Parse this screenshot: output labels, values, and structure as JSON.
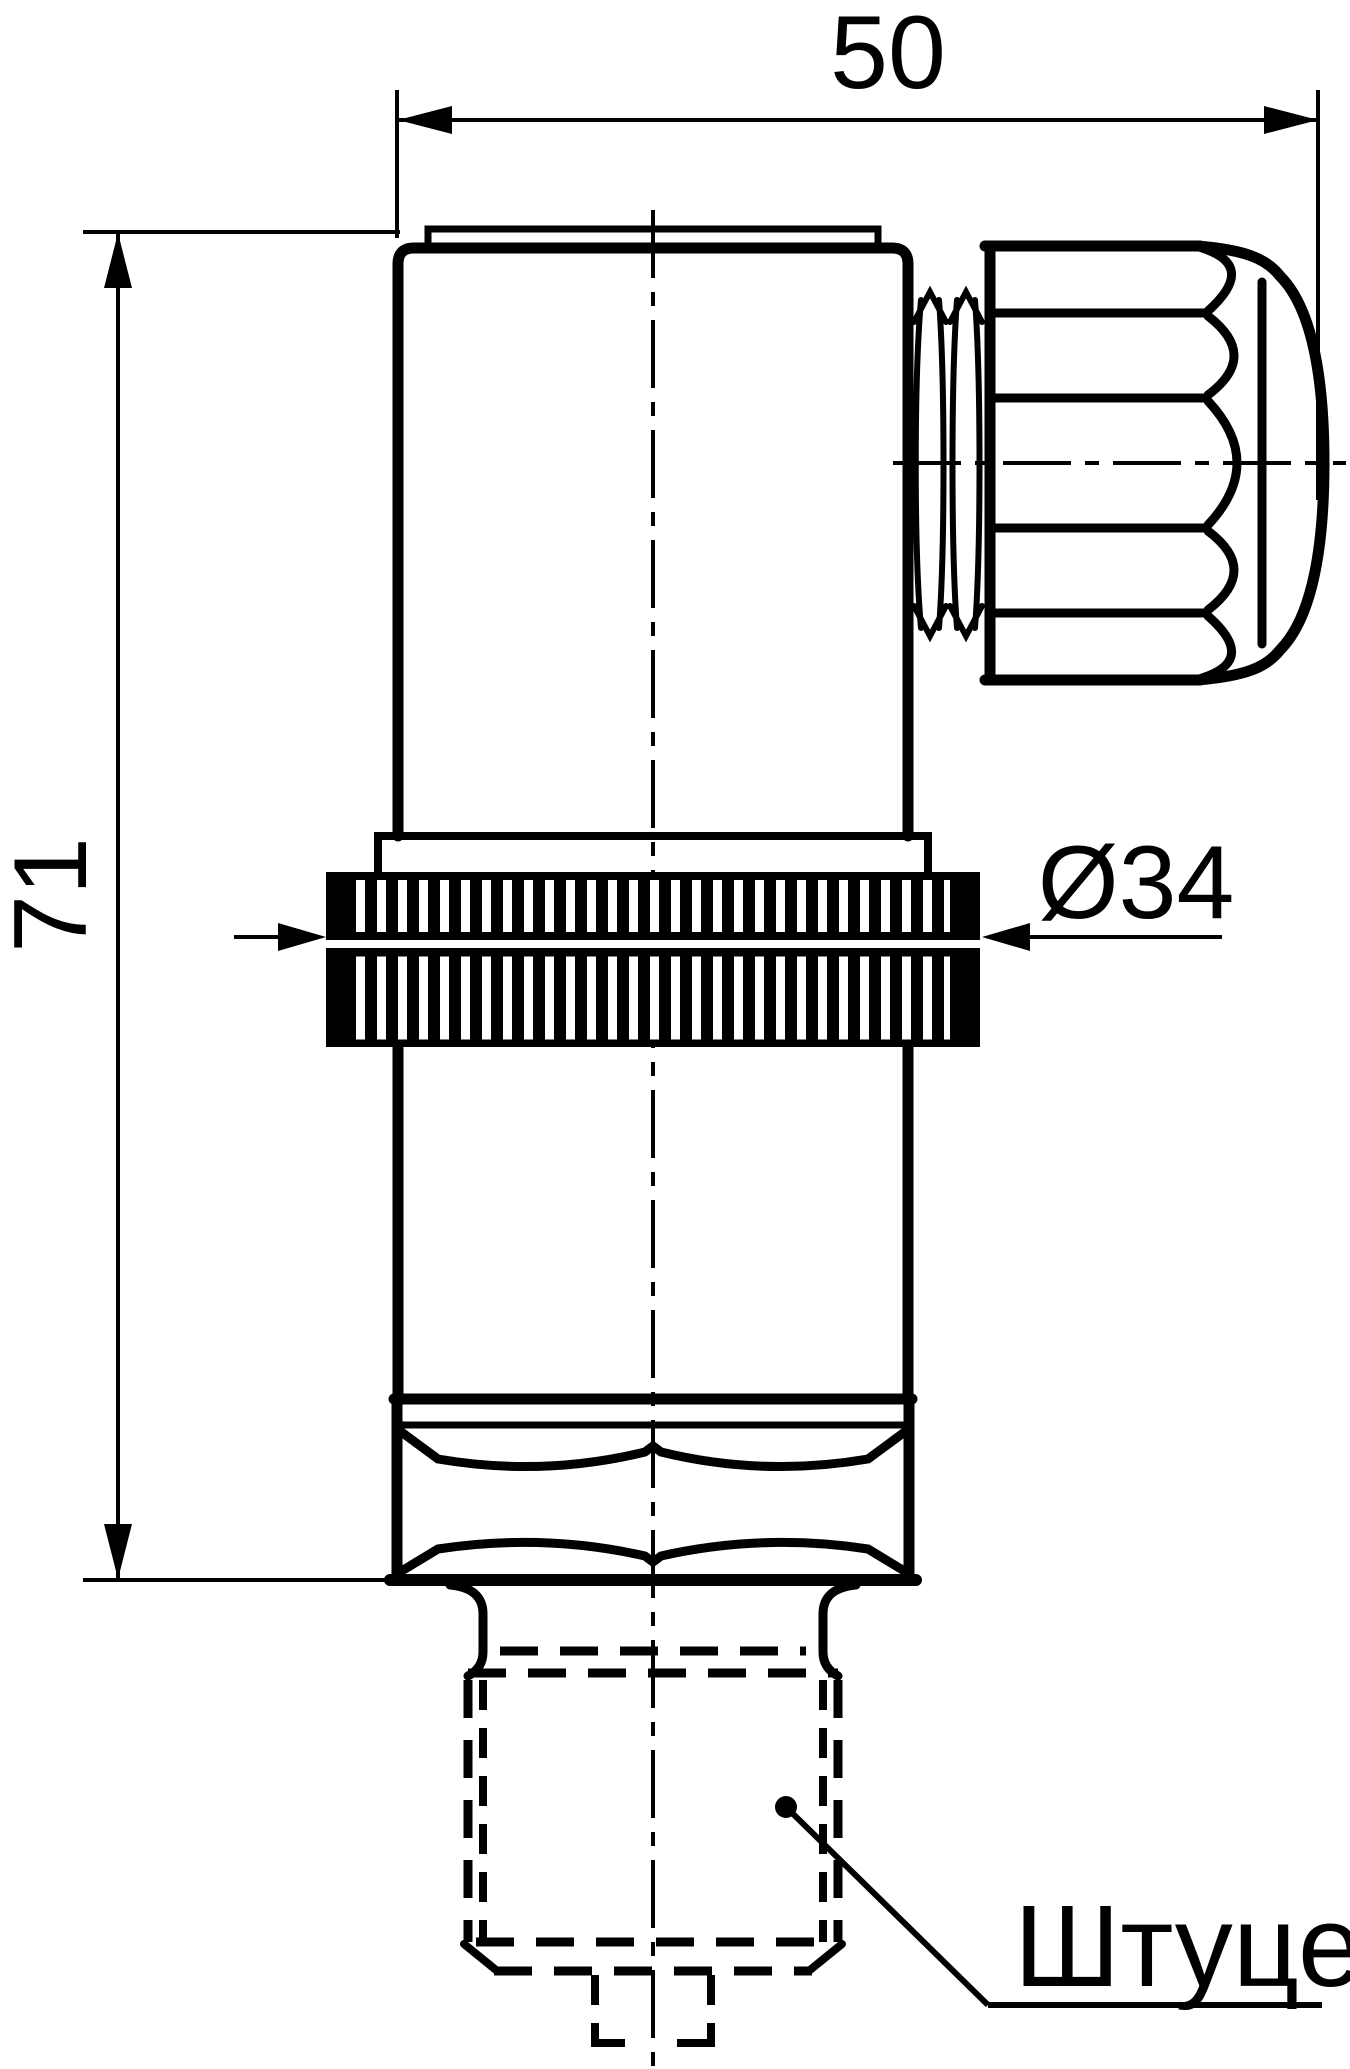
{
  "dimensions": {
    "width": "50",
    "height": "71",
    "knurl_diameter": "Ø34"
  },
  "labels": {
    "fitting": "Штуцер"
  },
  "colors": {
    "ink": "#000000",
    "paper": "#ffffff"
  }
}
